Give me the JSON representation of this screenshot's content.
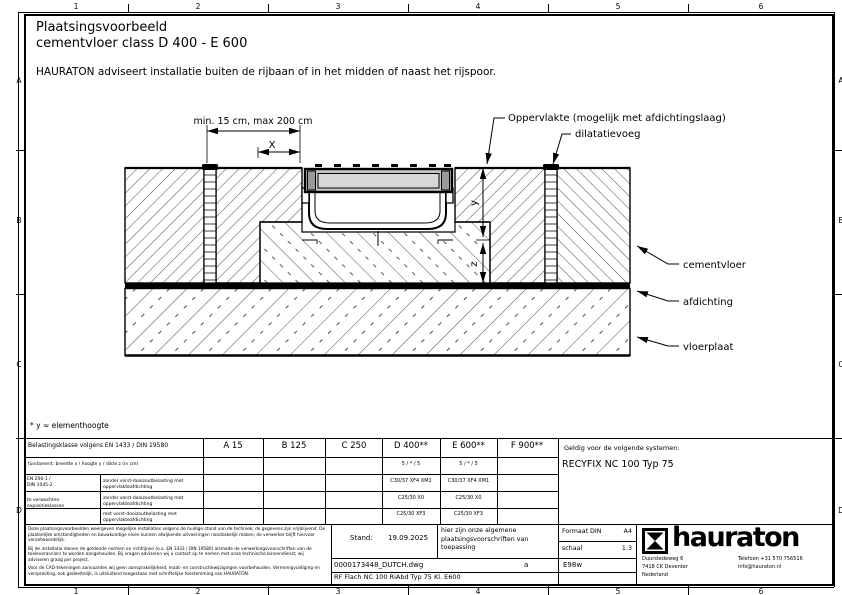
{
  "header": {
    "title_line1": "Plaatsingsvoorbeeld",
    "title_line2": "cementvloer class D 400 - E 600",
    "advice": "HAURATON adviseert installatie buiten de rijbaan of in het midden of naast het rijspoor."
  },
  "grid": {
    "cols": [
      "1",
      "2",
      "3",
      "4",
      "5",
      "6"
    ],
    "rows": [
      "A",
      "B",
      "C",
      "D"
    ]
  },
  "drawing": {
    "dim_top": "min. 15 cm, max 200 cm",
    "dim_x": "X",
    "dim_y": "y",
    "dim_z": "z",
    "label_surface": "Oppervlakte (mogelijk met afdichtingslaag)",
    "label_joint": "dilatatievoeg",
    "label_cement": "cementvloer",
    "label_seal": "afdichting",
    "label_slab": "vloerplaat",
    "note": "* y ≈ elementhoogte"
  },
  "table": {
    "load_class_header": "Belastingsklasse volgens EN 1433 / DIN 19580",
    "classes": [
      "A 15",
      "B 125",
      "C 250",
      "D 400**",
      "E 600**",
      "F 900**"
    ],
    "foundation_label": "fundament:  breedte x / hoogte y / dikte z (in cm)",
    "foundation_d400": "5 / * / 5",
    "foundation_e600": "5 / * / 5",
    "concrete_norm_line1": "EN 206-1 /",
    "concrete_norm_line2": "DIN 1045-2",
    "concrete_norm_line3": "te verwachten",
    "concrete_norm_line4": "expositieklassen",
    "rows": [
      {
        "label": "zonder vorst-dooizoutbelasting met oppervlakteafdichting",
        "d400": "C30/37 XF4 XM1",
        "e600": "C30/37 XF4 XM1"
      },
      {
        "label": "zonder vorst-dooizoutbelasting met oppervlakteafdichting",
        "d400": "C25/30 X0",
        "e600": "C25/30 X0"
      },
      {
        "label": "met vorst-dooizoutbelasting met oppervlakteafdichting",
        "d400": "C25/30 XF3",
        "e600": "C25/30 XF3"
      }
    ],
    "valid_label": "Geldig voor de volgende systemen:",
    "valid_value": "RECYFIX NC 100 Typ 75"
  },
  "titleblock": {
    "disclaimer_p1": "Deze plaatsingsvoorbeelden weergeven mogelijke installaties volgens de huidige stand van de techniek; de gegevens zijn vrijblijvend. De plaatselijke omstandigheden en bouwkundige eisen kunnen afwijkende uitvoeringen noodzakelijk maken; de verwerker blijft hiervoor verantwoordelijk.",
    "disclaimer_p2": "Bij de installatie dienen de geldende normen en richtlijnen (o.a. EN 1433 / DIN 19580) alsmede de verwerkingsvoorschriften van de toeleveranciers te worden aangehouden. Bij vragen adviseren wij u contact op te nemen met onze technische binnendienst; wij adviseren graag per project.",
    "disclaimer_p3": "Voor de CAD-tekeningen aanvaarden wij geen aansprakelijkheid; maat- en constructiewijzigingen voorbehouden. Vermenigvuldiging en verspreiding, ook gedeeltelijk, is uitsluitend toegestaan met schriftelijke toestemming van HAURATON.",
    "stand_label": "Stand:",
    "stand_value": "19.09.2025",
    "general_note": "hier zijn onze algemene plaatsingsvoorschriften van toepassing",
    "format_label": "Formaat DIN",
    "format_value": "A4",
    "scale_label": "schaal",
    "scale_value": "1:3",
    "file_name": "0000173448_DUTCH.dwg",
    "revision": "a",
    "author": "E98w",
    "drawing_title": "RF Flach NC 100 RiAbd Typ 75 Kl. E600",
    "company": {
      "name": "hauraton",
      "address1": "Duurstedeweg 6",
      "address2": "7418 CK Deventer",
      "address3": "Nederland",
      "phone": "Telefoon +31 570 756516",
      "email": "info@hauraton.nl"
    }
  },
  "colors": {
    "line": "#000000",
    "grate": "#c6c6c6",
    "grate_inner": "#d8d8d8",
    "bg": "#ffffff"
  }
}
